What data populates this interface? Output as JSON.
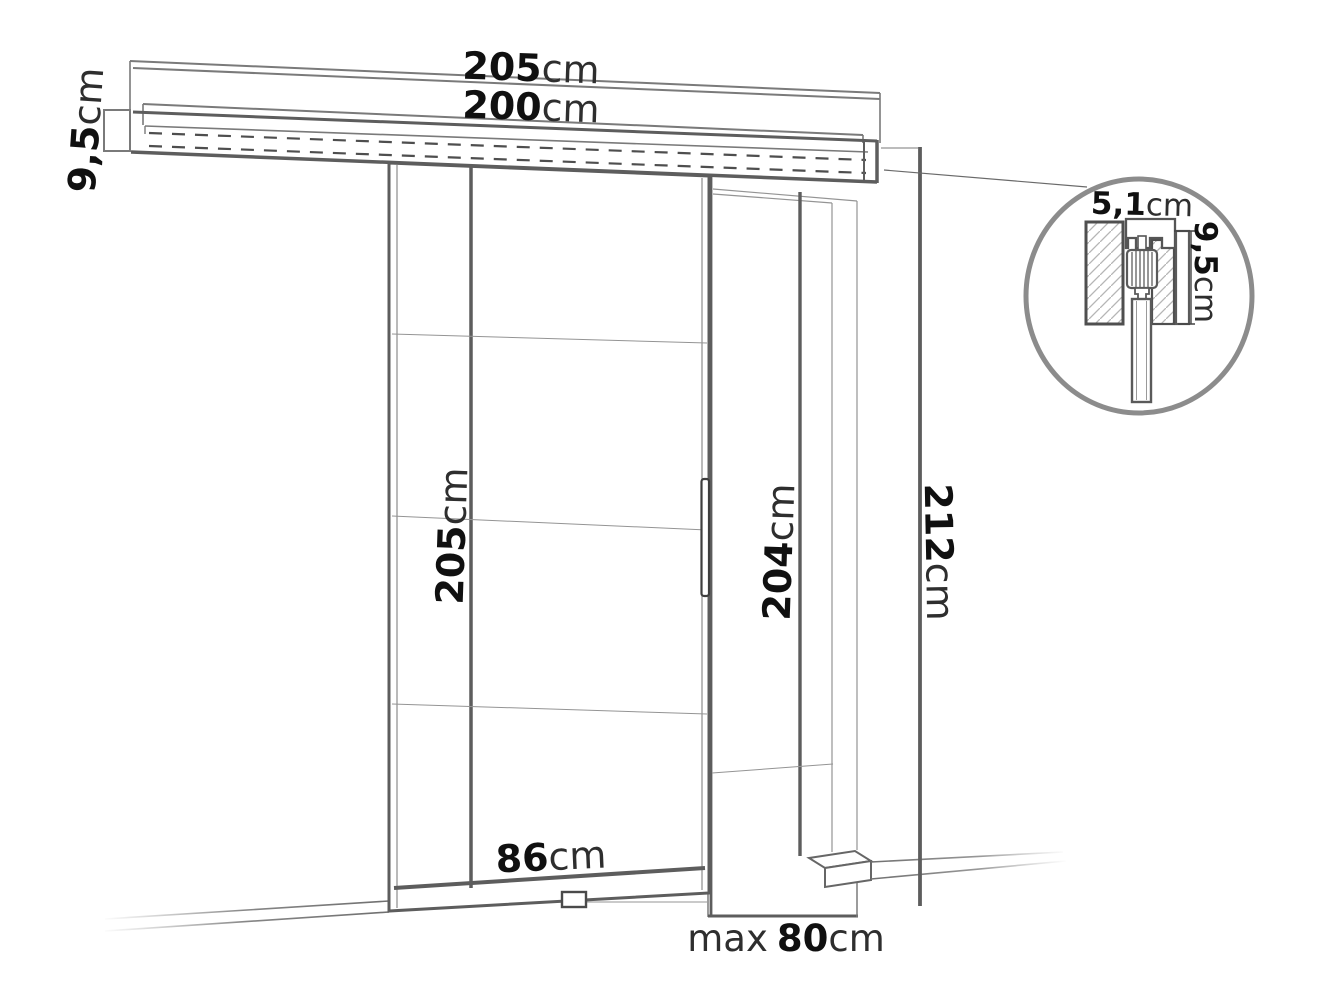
{
  "labels": {
    "track_total_length": {
      "value": "205",
      "unit": "cm"
    },
    "track_inner_length": {
      "value": "200",
      "unit": "cm"
    },
    "track_profile_height": {
      "value": "9,5",
      "unit": "cm"
    },
    "door_height": {
      "value": "205",
      "unit": "cm"
    },
    "door_width": {
      "value": "86",
      "unit": "cm"
    },
    "opening_height": {
      "value": "204",
      "unit": "cm"
    },
    "opening_max_width": {
      "prefix": "max",
      "value": "80",
      "unit": "cm"
    },
    "overall_height": {
      "value": "212",
      "unit": "cm"
    },
    "detail_track_width": {
      "value": "5,1",
      "unit": "cm"
    },
    "detail_track_height": {
      "value": "9,5",
      "unit": "cm"
    }
  },
  "colors": {
    "background": "#ffffff",
    "line_strong": "#5d5d5d",
    "line_medium": "#7a7a7a",
    "line_light": "#949494",
    "hatch": "#b5b5b5",
    "number_text": "#101010",
    "unit_text": "#2e2e2e"
  }
}
